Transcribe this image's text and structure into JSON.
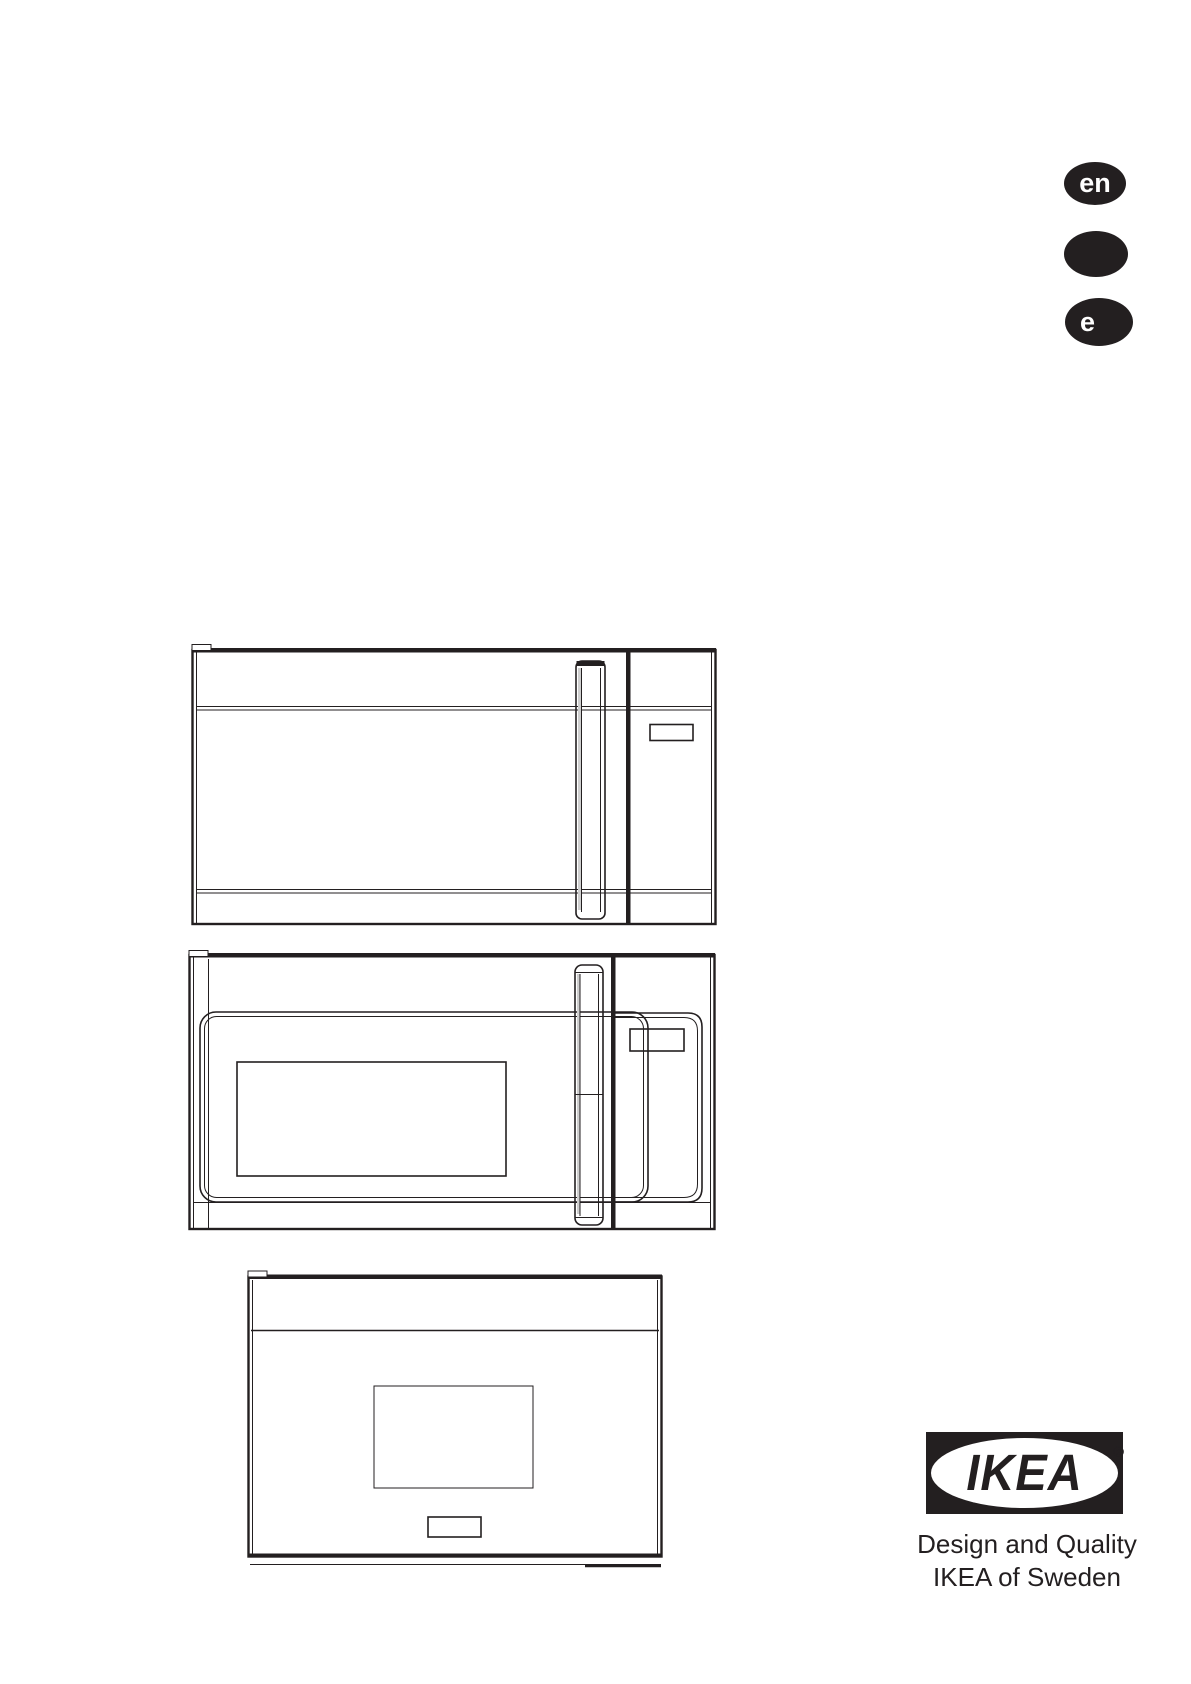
{
  "colors": {
    "ink": "#231f20",
    "paper": "#ffffff"
  },
  "language_badges": {
    "items": [
      {
        "label": "en"
      },
      {
        "label": ""
      },
      {
        "label": "e"
      }
    ]
  },
  "illustrations": {
    "items": [
      {
        "name": "over-the-range-microwave-front-closed"
      },
      {
        "name": "over-the-range-microwave-front-with-window"
      },
      {
        "name": "built-in-compact-microwave-front"
      }
    ]
  },
  "footer": {
    "logo_text": "IKEA",
    "registered_mark": "®",
    "tagline_line1": "Design and Quality",
    "tagline_line2": "IKEA of Sweden"
  }
}
